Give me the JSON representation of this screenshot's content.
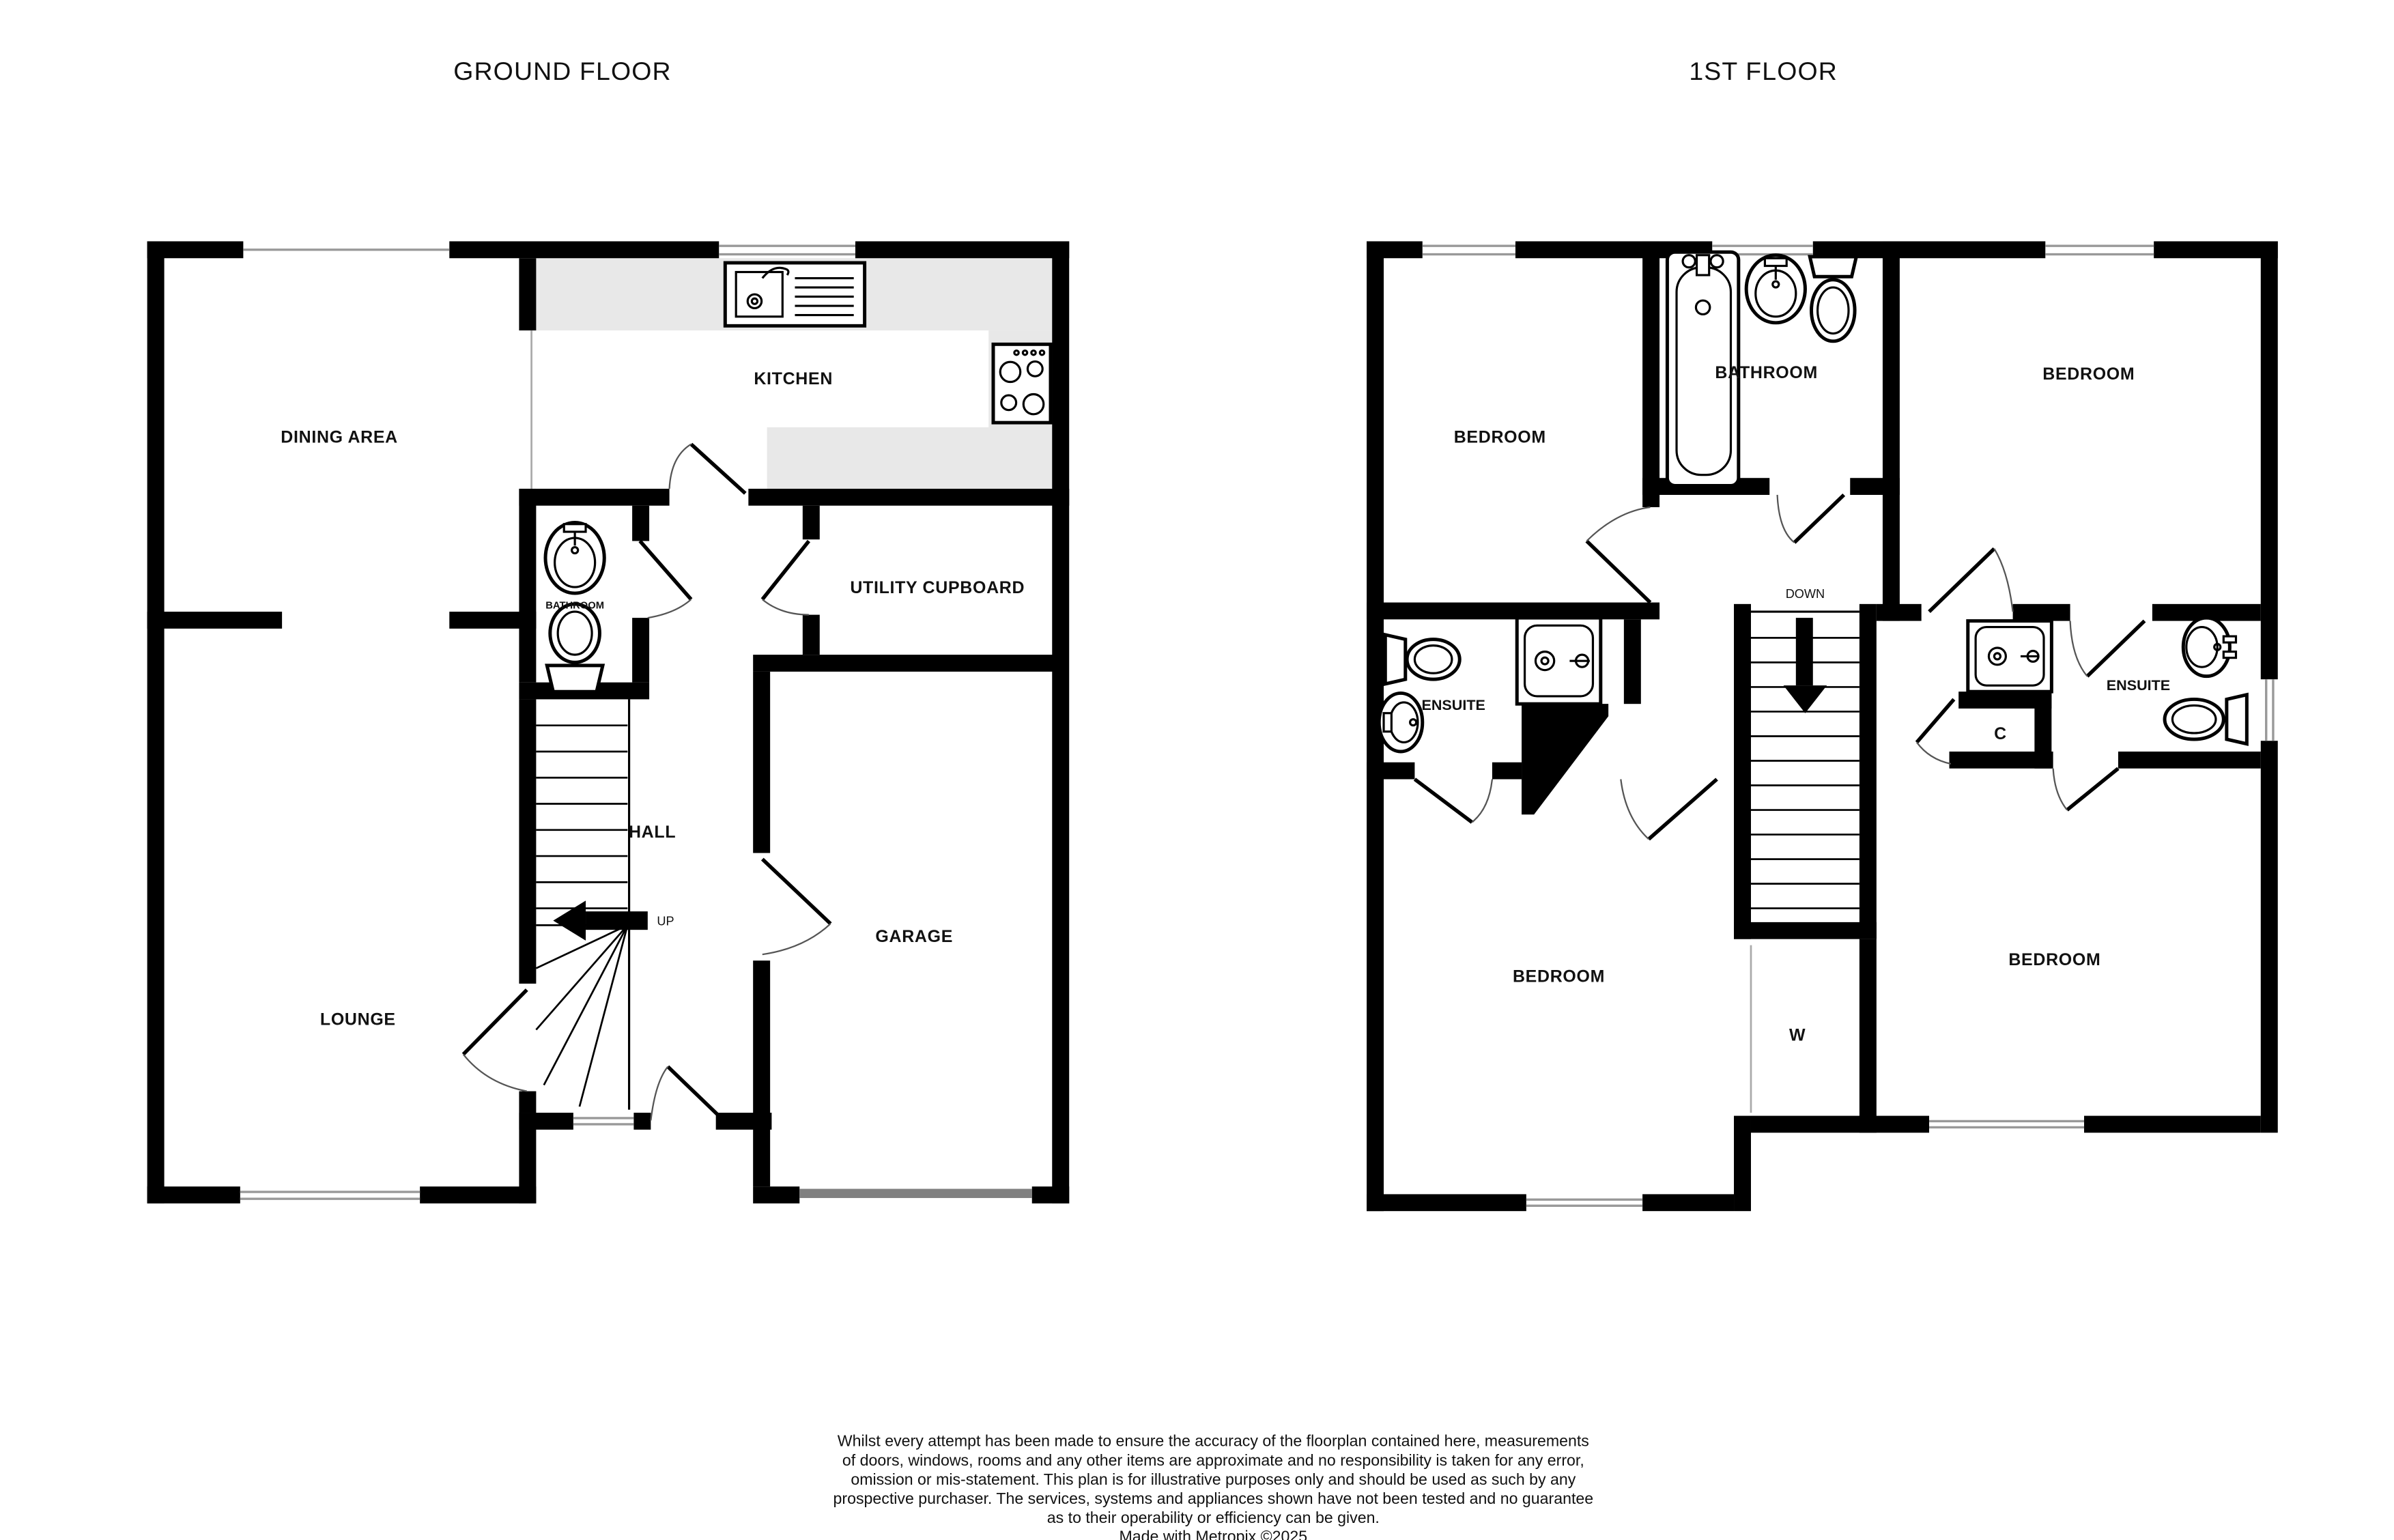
{
  "ground_floor": {
    "title": "GROUND FLOOR",
    "rooms": {
      "dining_area": "DINING AREA",
      "kitchen": "KITCHEN",
      "bathroom": "BATHROOM",
      "utility_cupboard": "UTILITY CUPBOARD",
      "hall": "HALL",
      "lounge": "LOUNGE",
      "garage": "GARAGE"
    },
    "stair_direction": "UP"
  },
  "first_floor": {
    "title": "1ST FLOOR",
    "rooms": {
      "bedroom_top_left": "BEDROOM",
      "bathroom": "BATHROOM",
      "bedroom_top_right": "BEDROOM",
      "ensuite_left": "ENSUITE",
      "ensuite_right": "ENSUITE",
      "cupboard": "C",
      "wardrobe": "W",
      "bedroom_bottom_left": "BEDROOM",
      "bedroom_bottom_right": "BEDROOM"
    },
    "stair_direction": "DOWN"
  },
  "footer": {
    "disclaimer_lines": [
      "Whilst every attempt has been made to ensure the accuracy of the floorplan contained here, measurements",
      "of doors, windows, rooms and any other items are approximate and no responsibility is taken for any error,",
      "omission or mis-statement. This plan is for illustrative purposes only and should be used as such by any",
      "prospective purchaser. The services, systems and appliances shown have not been tested and no guarantee",
      "as to their operability or efficiency can be given.",
      "Made with Metropix ©2025"
    ]
  },
  "colors": {
    "wall": "#000000",
    "kitchen_counter": "#e8e8e8",
    "garage_door": "#808080",
    "window_line": "#999999",
    "door_arc": "#555555"
  }
}
